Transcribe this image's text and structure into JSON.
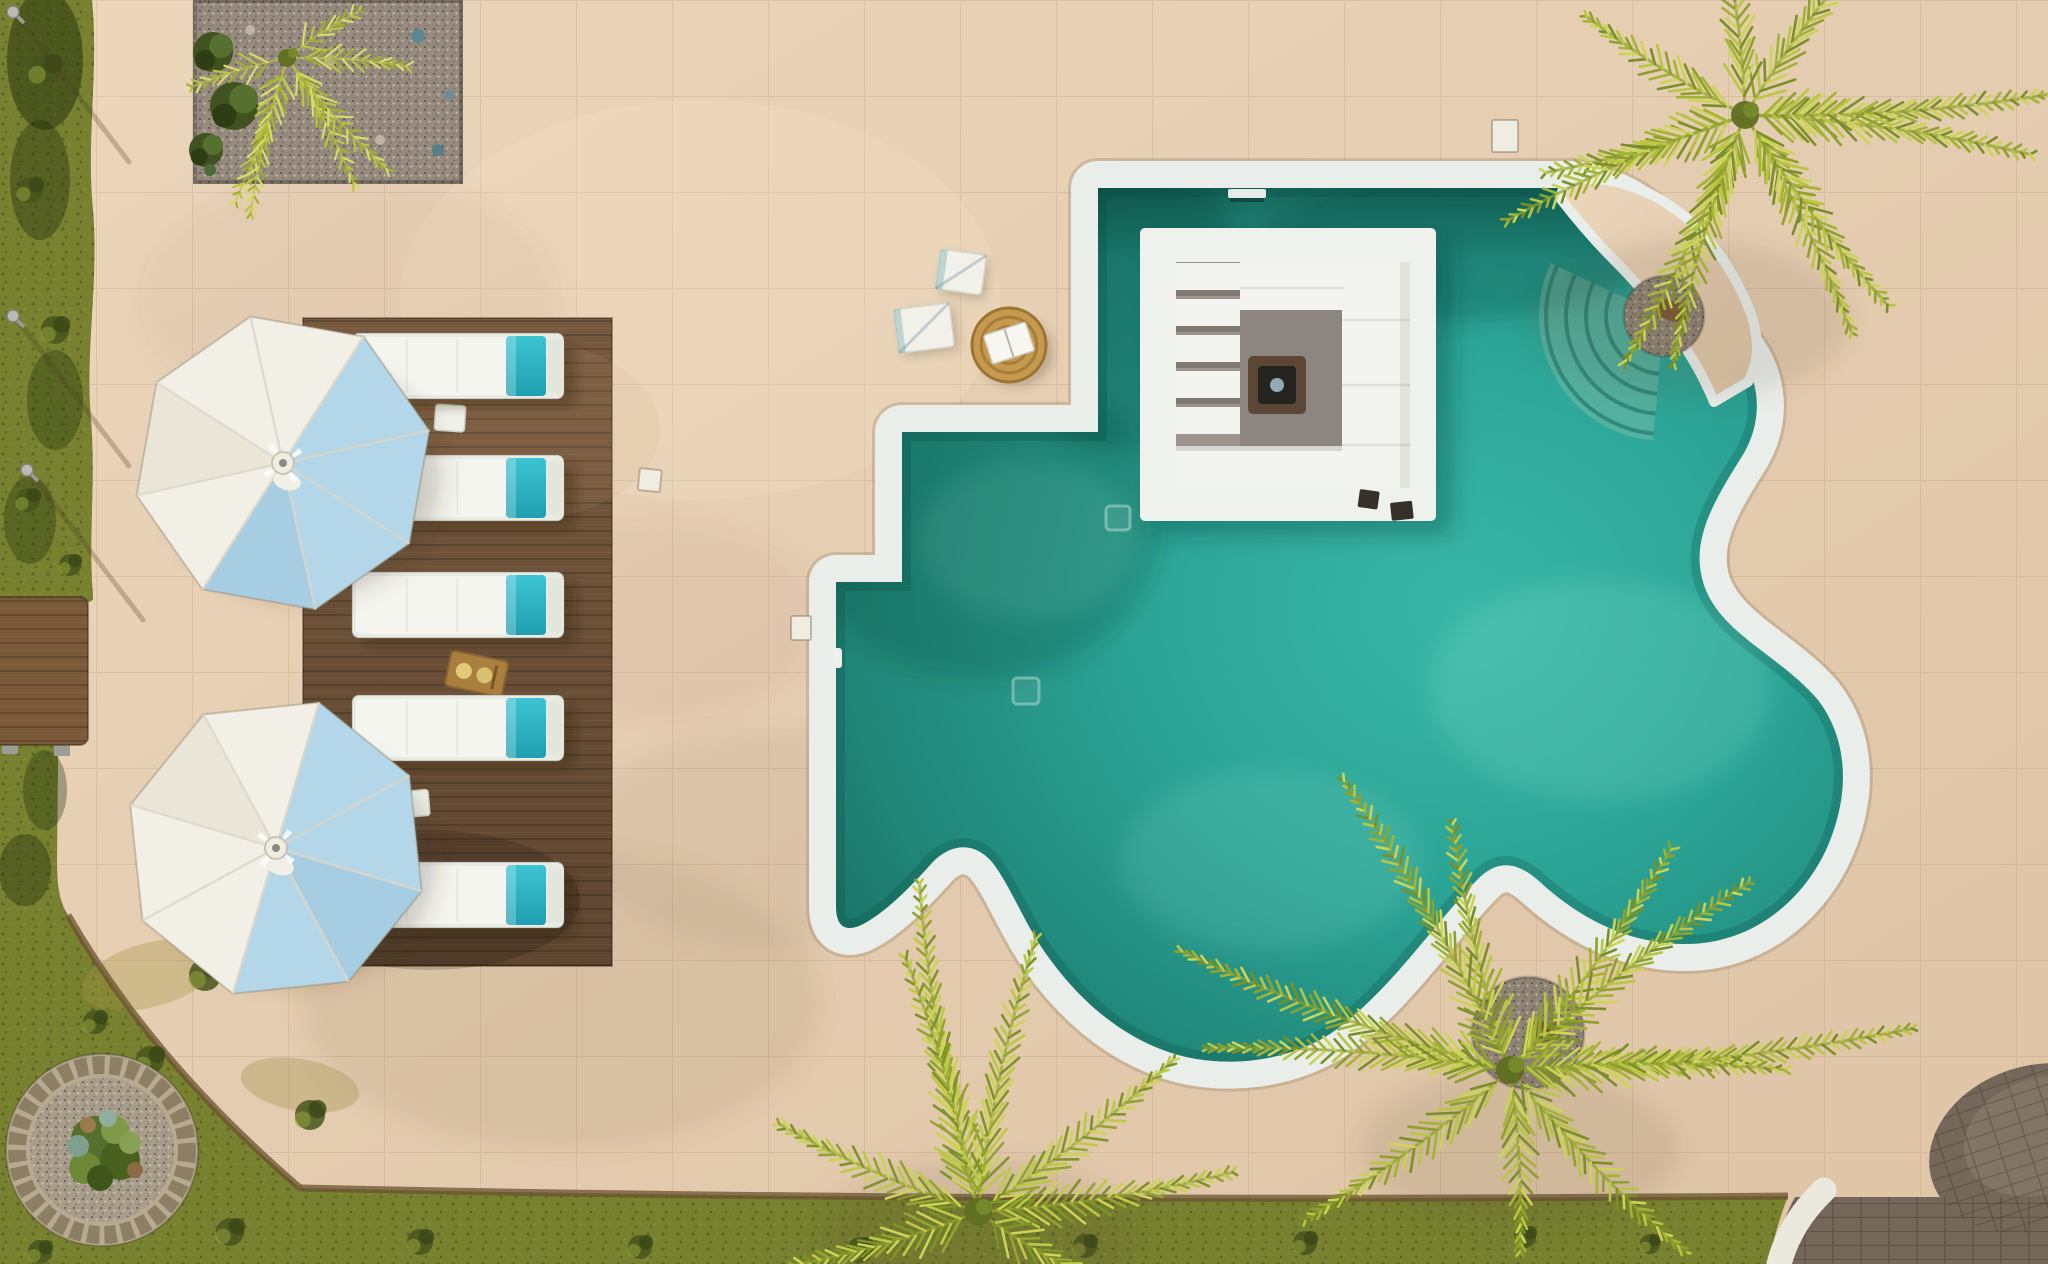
{
  "scene": {
    "title": "Aerial view of a villa terrace with freeform pool, sunken lounge island, sun loungers and palm trees",
    "type": "aerial-photo"
  },
  "colors": {
    "terrace": "#e4ccb0",
    "terraceLight": "#eedcc4",
    "coping": "#e9eeea",
    "copingEdge": "rgba(150,125,95,0.30)",
    "water": {
      "deep": "#186a5e",
      "mid": "#21897b",
      "bright": "#2ba496",
      "light": "#39b7a6"
    },
    "deck": "#6d523a",
    "lounger": {
      "frame": "#e9ebe3",
      "cushion": "#f5f5f0",
      "towel": "#2db6c5",
      "towelDark": "#1f9fb1",
      "tab": "#e3e6dc"
    },
    "umbrella": {
      "w": "#f1efe6",
      "c": "#e9e6d8",
      "b": "#b3d6e8",
      "b2": "#a6cde1",
      "rib": "#ddd8c8",
      "hub": "#efece2"
    },
    "grass": {
      "base": "#77812f",
      "dark": "#46531c",
      "light": "#98a53b"
    },
    "gravel": "#958a7d",
    "pebble": "#8e8374",
    "bench": "#7b5a3a",
    "tray": "#a97f3e",
    "pavers": "#75685a",
    "paversLight": "#8a8170",
    "stripe": "#ebe8dd",
    "island": {
      "white": "#eef1ec",
      "recess": "#9b948c",
      "floor": "#8d8680",
      "sofa": "#f3f4f0",
      "back": "#e2e4da",
      "pitBase": "#5c4636",
      "pitTop": "#26241f",
      "pitGlass": "#9fb9c2"
    },
    "plant": {
      "crown": "#5f6f22"
    },
    "planterRing": "#b7aa90",
    "planterCobble": "#8d7f64",
    "planterGravel": "#a89c8b",
    "ornament": "#7a5a36"
  },
  "loungers": {
    "count": 5,
    "x": 352,
    "width": 212,
    "height": 66,
    "rows": [
      333,
      455,
      572,
      695,
      862
    ]
  },
  "sideTables": [
    {
      "x": 436,
      "y": 404,
      "rot": 4
    },
    {
      "x": 398,
      "y": 792,
      "rot": -5
    }
  ],
  "tray": {
    "x": 452,
    "y": 650,
    "rot": 12
  },
  "umbrellas": [
    {
      "cx": 283,
      "cy": 463,
      "r": 150,
      "rot": 10,
      "slices": [
        "w",
        "b",
        "b",
        "b",
        "b2",
        "w",
        "c",
        "w"
      ]
    },
    {
      "cx": 276,
      "cy": 848,
      "r": 152,
      "rot": -6,
      "slices": [
        "w",
        "b",
        "b",
        "b2",
        "b",
        "w",
        "w",
        "c"
      ]
    }
  ],
  "palms": [
    {
      "name": "palm-top-right",
      "cx": 1745,
      "cy": 115,
      "shadow": [
        1690,
        320
      ],
      "fronds": [
        {
          "a": 172,
          "len": 205
        },
        {
          "a": 148,
          "len": 255
        },
        {
          "a": 124,
          "len": 270
        },
        {
          "a": 98,
          "len": 255
        },
        {
          "a": 72,
          "len": 240
        },
        {
          "a": 45,
          "len": 235
        },
        {
          "a": 16,
          "len": 285
        },
        {
          "a": -12,
          "len": 300
        },
        {
          "a": -45,
          "len": 230
        },
        {
          "a": -105,
          "len": 170
        },
        {
          "a": -140,
          "len": 185
        }
      ],
      "palette": [
        "#8fa02c",
        "#b9c63f",
        "#7a8f26",
        "#ccd455",
        "#a3b435"
      ]
    },
    {
      "name": "palm-bottom-right",
      "cx": 1510,
      "cy": 1070,
      "shadow": [
        1520,
        1150
      ],
      "fronds": [
        {
          "a": -95,
          "len": 250
        },
        {
          "a": -128,
          "len": 330
        },
        {
          "a": -152,
          "len": 345
        },
        {
          "a": 176,
          "len": 300
        },
        {
          "a": 152,
          "len": 250
        },
        {
          "a": -62,
          "len": 270
        },
        {
          "a": -30,
          "len": 300
        },
        {
          "a": -14,
          "len": 400
        },
        {
          "a": 8,
          "len": 270
        },
        {
          "a": 38,
          "len": 250
        },
        {
          "a": 95,
          "len": 180
        }
      ],
      "palette": [
        "#8fa02c",
        "#b9c63f",
        "#7a8f26",
        "#ccd455",
        "#a3b435"
      ]
    },
    {
      "name": "palm-bottom-center",
      "cx": 978,
      "cy": 1212,
      "shadow": [
        980,
        1240
      ],
      "fronds": [
        {
          "a": -92,
          "len": 330
        },
        {
          "a": -114,
          "len": 260
        },
        {
          "a": -70,
          "len": 275
        },
        {
          "a": -46,
          "len": 245
        },
        {
          "a": -148,
          "len": 215
        },
        {
          "a": -17,
          "len": 255
        },
        {
          "a": 172,
          "len": 190
        },
        {
          "a": 22,
          "len": 170
        }
      ],
      "palette": [
        "#93a430",
        "#bcc944",
        "#7e9428",
        "#ccd455"
      ]
    },
    {
      "name": "palm-sapling-gravel-bed",
      "cx": 287,
      "cy": 58,
      "small": true,
      "fronds": [
        {
          "a": 118,
          "len": 150
        },
        {
          "a": 95,
          "len": 158
        },
        {
          "a": 70,
          "len": 140
        },
        {
          "a": 40,
          "len": 148
        },
        {
          "a": 12,
          "len": 118
        },
        {
          "a": 155,
          "len": 98
        },
        {
          "a": -25,
          "len": 85
        }
      ],
      "palette": [
        "#b9c53e",
        "#9fb22f",
        "#d6dd66"
      ]
    }
  ],
  "lamps": [
    {
      "x": 13,
      "y": 12
    },
    {
      "x": 13,
      "y": 316
    },
    {
      "x": 27,
      "y": 470
    }
  ],
  "covers": [
    {
      "x": 640,
      "y": 468,
      "w": 22,
      "h": 22,
      "rot": 6
    },
    {
      "x": 791,
      "y": 616,
      "w": 20,
      "h": 24,
      "rot": 0
    },
    {
      "x": 1492,
      "y": 120,
      "w": 26,
      "h": 32,
      "rot": 0
    }
  ],
  "towels": [
    {
      "x": 938,
      "y": 252,
      "w": 46,
      "h": 40,
      "rot": 8
    },
    {
      "x": 896,
      "y": 306,
      "w": 56,
      "h": 44,
      "rot": -7
    }
  ],
  "pouf": {
    "cx": 1009,
    "cy": 345,
    "r": 37,
    "book": {
      "x": 987,
      "y": 328,
      "w": 44,
      "h": 30,
      "rot": -18
    }
  },
  "steps": {
    "cx": 1664,
    "cy": 316,
    "radii": [
      58,
      78,
      98,
      118
    ],
    "a0": 95,
    "a1": 205
  },
  "drains": [
    {
      "x": 1013,
      "y": 678,
      "s": 26
    },
    {
      "x": 1106,
      "y": 506,
      "s": 24
    }
  ],
  "skimmer": {
    "x": 1228,
    "y": 189,
    "w": 38,
    "h": 9
  },
  "rail": {
    "x": 833,
    "y": 648,
    "w": 9,
    "h": 20
  },
  "speakers": [
    {
      "x": 1360,
      "y": 489,
      "w": 20,
      "h": 18,
      "rot": 8
    },
    {
      "x": 1390,
      "y": 503,
      "w": 22,
      "h": 18,
      "rot": -6
    }
  ],
  "pebbleCircles": [
    {
      "cx": 1664,
      "cy": 316,
      "r": 40,
      "orn": {
        "x": 1672,
        "y": 311
      }
    },
    {
      "cx": 1528,
      "cy": 1033,
      "r": 56,
      "orn": {
        "x": 1544,
        "y": 1032
      }
    }
  ],
  "planter": {
    "cx": 102,
    "cy": 1150,
    "rOuter": 96,
    "rCobble": 85,
    "rInner": 72,
    "plants": [
      [
        95,
        1140,
        24,
        "#55702c"
      ],
      [
        120,
        1160,
        20,
        "#48611f"
      ],
      [
        85,
        1168,
        16,
        "#6d8836"
      ],
      [
        115,
        1130,
        14,
        "#7e9a49"
      ],
      [
        100,
        1178,
        13,
        "#3f5519"
      ],
      [
        130,
        1143,
        11,
        "#86a055"
      ],
      [
        78,
        1146,
        11,
        "#7fa08e"
      ],
      [
        108,
        1118,
        9,
        "#8fae9c"
      ],
      [
        88,
        1125,
        8,
        "#9a7a4e"
      ],
      [
        135,
        1170,
        8,
        "#8a6a42"
      ]
    ]
  },
  "gravelBed": {
    "x": 193,
    "y": 0,
    "w": 270,
    "h": 184,
    "shrubs": [
      [
        213,
        52,
        20
      ],
      [
        234,
        106,
        24
      ],
      [
        206,
        150,
        17
      ]
    ],
    "stones": [
      [
        418,
        36,
        7,
        "#5d8792"
      ],
      [
        438,
        150,
        6,
        "#57808a"
      ],
      [
        449,
        95,
        5,
        "#6a8e97"
      ],
      [
        210,
        170,
        6,
        "#4c6a3a"
      ],
      [
        250,
        30,
        5,
        "#bdb4a6"
      ],
      [
        330,
        60,
        6,
        "#b5aa98"
      ],
      [
        380,
        140,
        5,
        "#c0b6a4"
      ]
    ]
  },
  "tufts": [
    [
      45,
      70,
      16
    ],
    [
      30,
      190,
      13
    ],
    [
      55,
      330,
      14
    ],
    [
      28,
      500,
      12
    ],
    [
      70,
      565,
      11
    ],
    [
      205,
      975,
      16
    ],
    [
      150,
      1060,
      14
    ],
    [
      310,
      1115,
      15
    ],
    [
      95,
      1022,
      12
    ],
    [
      230,
      1232,
      14
    ],
    [
      420,
      1242,
      13
    ],
    [
      640,
      1247,
      12
    ],
    [
      860,
      1250,
      13
    ],
    [
      1085,
      1246,
      12
    ],
    [
      1305,
      1243,
      12
    ],
    [
      1525,
      1237,
      11
    ],
    [
      40,
      1252,
      12
    ],
    [
      1650,
      1244,
      10
    ]
  ],
  "caustics": [
    {
      "x": 1600,
      "y": 690,
      "rx": 170,
      "ry": 110,
      "o": 0.15
    },
    {
      "x": 1270,
      "y": 860,
      "rx": 150,
      "ry": 90,
      "o": 0.12
    },
    {
      "x": 1030,
      "y": 540,
      "rx": 110,
      "ry": 80,
      "o": 0.1
    }
  ],
  "darkWater": [
    {
      "x": 1120,
      "y": 300,
      "rx": 130,
      "ry": 150,
      "o": 0.28
    },
    {
      "x": 980,
      "y": 520,
      "rx": 180,
      "ry": 160,
      "o": 0.2
    },
    {
      "x": 1450,
      "y": 250,
      "rx": 200,
      "ry": 70,
      "o": 0.25
    }
  ]
}
